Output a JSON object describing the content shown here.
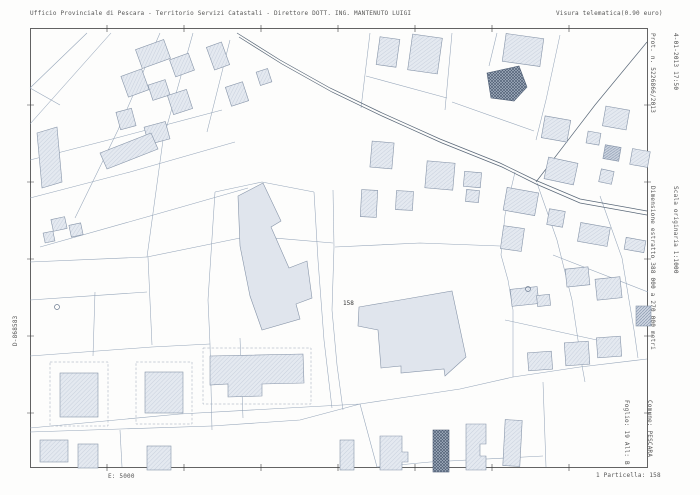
{
  "document_type": "estratto-di-mappa-catastale",
  "header": {
    "left": "Ufficio Provinciale di Pescara - Territorio Servizi Catastali - Direttore DOTT. ING. MANTENUTO LUIGI",
    "right": "Visura telematica(0.90 euro)"
  },
  "margin_right": {
    "datetime": "4-01-2013 17:50",
    "protocol": "Prot. n. 5226866/2013",
    "scale_note": "Scala originaria 1:1000",
    "size_note": "Dimensione estratto 388 000 a 270 000 metri",
    "comune": "Comune: PESCARA",
    "foglio": "Foglio: 19 All: B"
  },
  "margin_left": {
    "code": "D-868583"
  },
  "footer": {
    "scale": "E: 5000",
    "particella": "1 Particella: 158"
  },
  "map": {
    "highlight_parcel_label": "158"
  },
  "colors": {
    "paper": "#fdfdfc",
    "boundary_line": "#8fa0b5",
    "building_fill": "#e4e9f0",
    "building_stroke": "#8694a8",
    "dark_building": "#4e5d73",
    "frame": "#3c3c3c",
    "text": "#555555"
  }
}
